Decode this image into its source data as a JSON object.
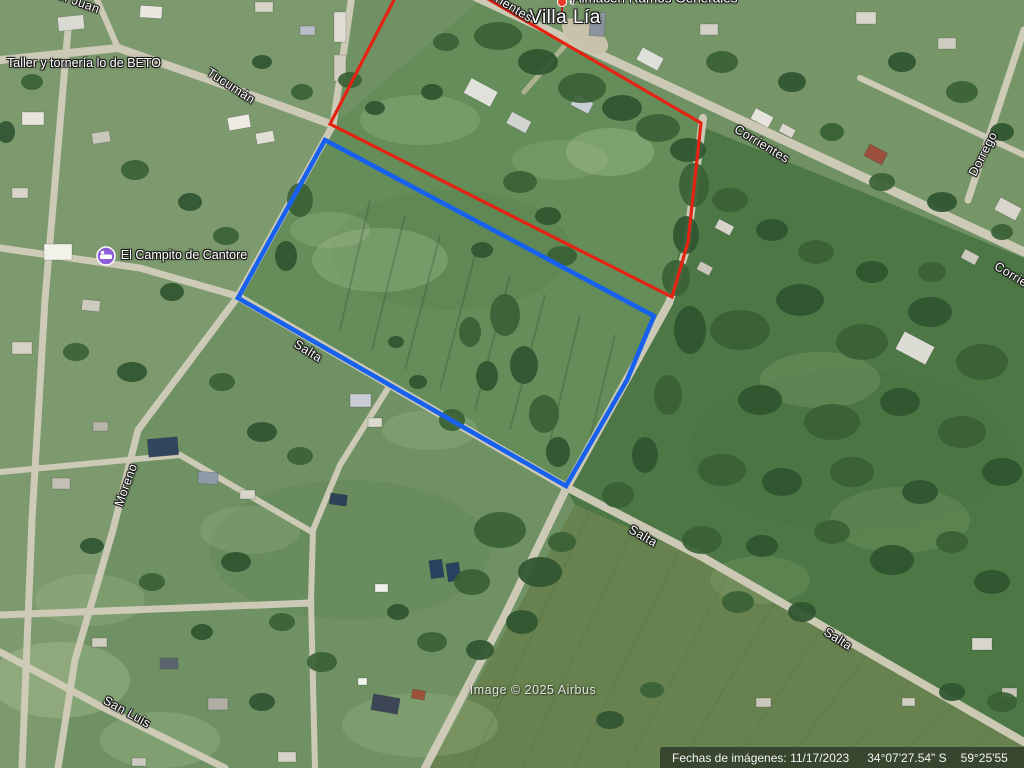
{
  "town_label": "Villa Lía",
  "poi": {
    "almacen": {
      "label": "Almacén Ramos Generales",
      "marker_color": "#ea3a2c"
    },
    "taller": {
      "label": "Taller y tornería lo de BETO"
    },
    "campito": {
      "label": "El Campito de Cantore",
      "icon_color": "#8e5fd6"
    }
  },
  "streets": {
    "tucuman": "Tucumán",
    "corrientes": "Corrientes",
    "dorrego": "Dorrego",
    "salta": "Salta",
    "moreno": "Moreno",
    "san_luis": "San Luis",
    "san_juan": "San Juan"
  },
  "overlays": {
    "red_parcel": {
      "color": "#e42313",
      "points": "396,-4 330,124 672,297 688,242 701,123 483,-4"
    },
    "blue_parcel": {
      "color": "#1761ee",
      "points": "325,140 654,316 627,380 566,486 238,298"
    }
  },
  "attribution": "Image © 2025 Airbus",
  "status_bar": {
    "imagery_date": "Fechas de imágenes: 11/17/2023",
    "latitude": "34°07'27.54\" S",
    "longitude": "59°25'55"
  }
}
